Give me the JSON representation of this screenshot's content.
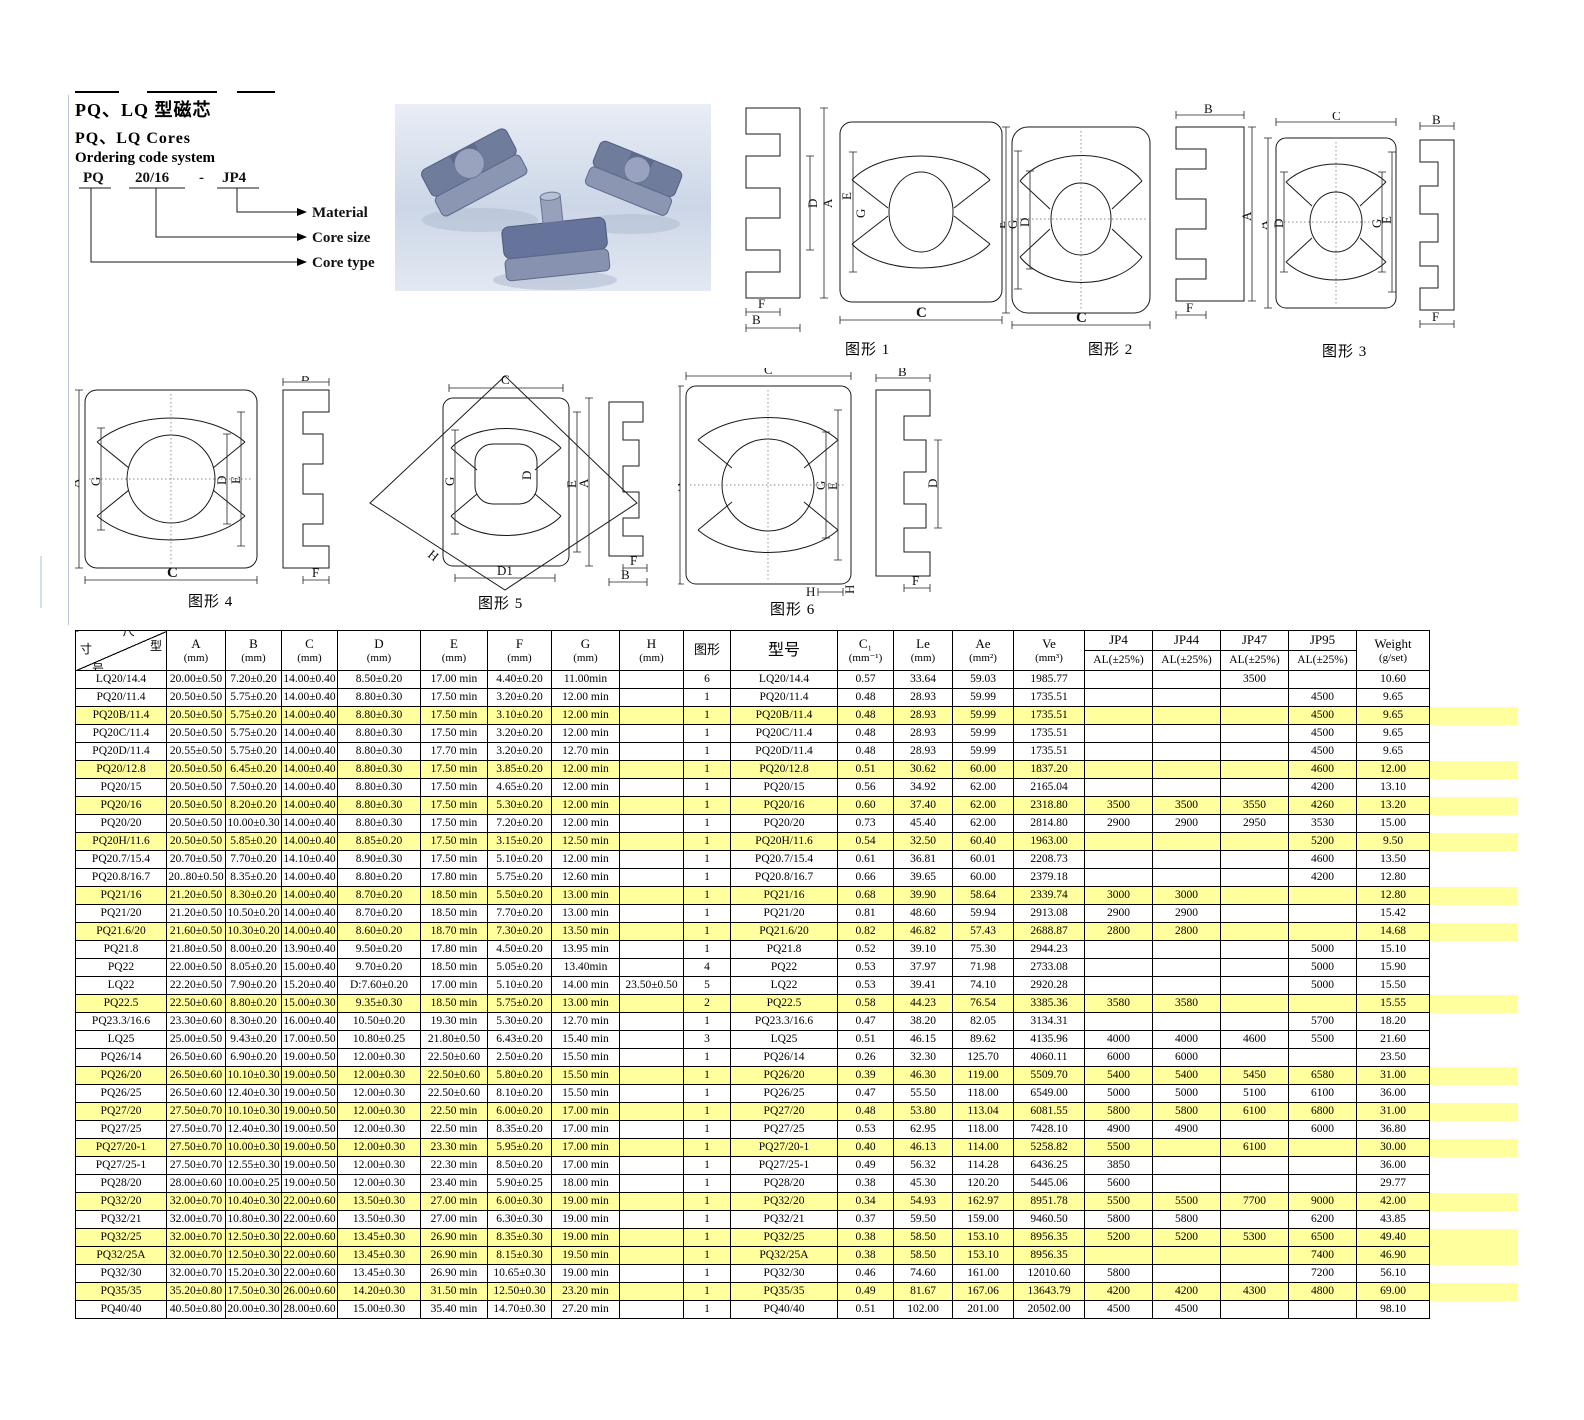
{
  "colors": {
    "highlight": "#ffff9e"
  },
  "page": {
    "title_cn": "PQ、LQ 型磁芯",
    "title_en": "PQ、LQ  Cores",
    "ordering_title": "Ordering code system",
    "code": {
      "part1": "PQ",
      "part2": "20/16",
      "dash": "-",
      "part3": "JP4"
    },
    "code_labels": {
      "material": "Material",
      "core_size": "Core size",
      "core_type": "Core type"
    }
  },
  "figures": {
    "f1": {
      "caption": "图形 1",
      "labels": [
        "D",
        "A",
        "F",
        "B",
        "E",
        "G",
        "C"
      ]
    },
    "f2": {
      "caption": "图形 2",
      "labels": [
        "E",
        "G",
        "D",
        "C",
        "B",
        "A",
        "F"
      ]
    },
    "f3": {
      "caption": "图形 3",
      "labels": [
        "C",
        "A",
        "D",
        "G",
        "E",
        "B",
        "F"
      ]
    },
    "f4": {
      "caption": "图形 4",
      "labels": [
        "A",
        "G",
        "D",
        "E",
        "C",
        "B",
        "F"
      ]
    },
    "f5": {
      "caption": "图形 5",
      "labels": [
        "C",
        "G",
        "D",
        "E",
        "A",
        "H",
        "D1",
        "F",
        "B"
      ]
    },
    "f6": {
      "caption": "图形 6",
      "labels": [
        "C",
        "A",
        "G",
        "E",
        "H",
        "H",
        "B",
        "D",
        "F"
      ]
    }
  },
  "table": {
    "diag": {
      "top": "尺",
      "right": "型",
      "left": "寸",
      "bottom": "号"
    },
    "columns": [
      {
        "l1": "A",
        "l2": "(mm)"
      },
      {
        "l1": "B",
        "l2": "(mm)"
      },
      {
        "l1": "C",
        "l2": "(mm)"
      },
      {
        "l1": "D",
        "l2": "(mm)"
      },
      {
        "l1": "E",
        "l2": "(mm)"
      },
      {
        "l1": "F",
        "l2": "(mm)"
      },
      {
        "l1": "G",
        "l2": "(mm)"
      },
      {
        "l1": "H",
        "l2": "(mm)"
      },
      {
        "l1": "图形"
      },
      {
        "l1": "型号",
        "big": true
      },
      {
        "l1": "C₁",
        "l2": "(mm⁻¹)"
      },
      {
        "l1": "Le",
        "l2": "(mm)"
      },
      {
        "l1": "Ae",
        "l2": "(mm²)"
      },
      {
        "l1": "Ve",
        "l2": "(mm³)"
      },
      {
        "l1": "JP4",
        "l2": "AL(±25%)",
        "split": true
      },
      {
        "l1": "JP44",
        "l2": "AL(±25%)",
        "split": true
      },
      {
        "l1": "JP47",
        "l2": "AL(±25%)",
        "split": true
      },
      {
        "l1": "JP95",
        "l2": "AL(±25%)",
        "split": true
      },
      {
        "l1": "Weight",
        "l2": "(g/set)"
      }
    ],
    "rows": [
      [
        "LQ20/14.4",
        "20.00±0.50",
        "7.20±0.20",
        "14.00±0.40",
        "8.50±0.20",
        "17.00 min",
        "4.40±0.20",
        "11.00min",
        "",
        "6",
        "LQ20/14.4",
        "0.57",
        "33.64",
        "59.03",
        "1985.77",
        "",
        "",
        "3500",
        "",
        "10.60",
        0
      ],
      [
        "PQ20/11.4",
        "20.50±0.50",
        "5.75±0.20",
        "14.00±0.40",
        "8.80±0.30",
        "17.50 min",
        "3.20±0.20",
        "12.00 min",
        "",
        "1",
        "PQ20/11.4",
        "0.48",
        "28.93",
        "59.99",
        "1735.51",
        "",
        "",
        "",
        "4500",
        "9.65",
        0
      ],
      [
        "PQ20B/11.4",
        "20.50±0.50",
        "5.75±0.20",
        "14.00±0.40",
        "8.80±0.30",
        "17.50 min",
        "3.10±0.20",
        "12.00 min",
        "",
        "1",
        "PQ20B/11.4",
        "0.48",
        "28.93",
        "59.99",
        "1735.51",
        "",
        "",
        "",
        "4500",
        "9.65",
        1
      ],
      [
        "PQ20C/11.4",
        "20.50±0.50",
        "5.75±0.20",
        "14.00±0.40",
        "8.80±0.30",
        "17.50 min",
        "3.20±0.20",
        "12.00 min",
        "",
        "1",
        "PQ20C/11.4",
        "0.48",
        "28.93",
        "59.99",
        "1735.51",
        "",
        "",
        "",
        "4500",
        "9.65",
        0
      ],
      [
        "PQ20D/11.4",
        "20.55±0.50",
        "5.75±0.20",
        "14.00±0.40",
        "8.80±0.30",
        "17.70 min",
        "3.20±0.20",
        "12.70 min",
        "",
        "1",
        "PQ20D/11.4",
        "0.48",
        "28.93",
        "59.99",
        "1735.51",
        "",
        "",
        "",
        "4500",
        "9.65",
        0
      ],
      [
        "PQ20/12.8",
        "20.50±0.50",
        "6.45±0.20",
        "14.00±0.40",
        "8.80±0.30",
        "17.50 min",
        "3.85±0.20",
        "12.00 min",
        "",
        "1",
        "PQ20/12.8",
        "0.51",
        "30.62",
        "60.00",
        "1837.20",
        "",
        "",
        "",
        "4600",
        "12.00",
        1
      ],
      [
        "PQ20/15",
        "20.50±0.50",
        "7.50±0.20",
        "14.00±0.40",
        "8.80±0.30",
        "17.50 min",
        "4.65±0.20",
        "12.00 min",
        "",
        "1",
        "PQ20/15",
        "0.56",
        "34.92",
        "62.00",
        "2165.04",
        "",
        "",
        "",
        "4200",
        "13.10",
        0
      ],
      [
        "PQ20/16",
        "20.50±0.50",
        "8.20±0.20",
        "14.00±0.40",
        "8.80±0.30",
        "17.50 min",
        "5.30±0.20",
        "12.00 min",
        "",
        "1",
        "PQ20/16",
        "0.60",
        "37.40",
        "62.00",
        "2318.80",
        "3500",
        "3500",
        "3550",
        "4260",
        "13.20",
        1
      ],
      [
        "PQ20/20",
        "20.50±0.50",
        "10.00±0.30",
        "14.00±0.40",
        "8.80±0.30",
        "17.50 min",
        "7.20±0.20",
        "12.00 min",
        "",
        "1",
        "PQ20/20",
        "0.73",
        "45.40",
        "62.00",
        "2814.80",
        "2900",
        "2900",
        "2950",
        "3530",
        "15.00",
        0
      ],
      [
        "PQ20H/11.6",
        "20.50±0.50",
        "5.85±0.20",
        "14.00±0.40",
        "8.85±0.20",
        "17.50 min",
        "3.15±0.20",
        "12.50 min",
        "",
        "1",
        "PQ20H/11.6",
        "0.54",
        "32.50",
        "60.40",
        "1963.00",
        "",
        "",
        "",
        "5200",
        "9.50",
        1
      ],
      [
        "PQ20.7/15.4",
        "20.70±0.50",
        "7.70±0.20",
        "14.10±0.40",
        "8.90±0.30",
        "17.50 min",
        "5.10±0.20",
        "12.00 min",
        "",
        "1",
        "PQ20.7/15.4",
        "0.61",
        "36.81",
        "60.01",
        "2208.73",
        "",
        "",
        "",
        "4600",
        "13.50",
        0
      ],
      [
        "PQ20.8/16.7",
        "20..80±0.50",
        "8.35±0.20",
        "14.00±0.40",
        "8.80±0.20",
        "17.80 min",
        "5.75±0.20",
        "12.60 min",
        "",
        "1",
        "PQ20.8/16.7",
        "0.66",
        "39.65",
        "60.00",
        "2379.18",
        "",
        "",
        "",
        "4200",
        "12.80",
        0
      ],
      [
        "PQ21/16",
        "21.20±0.50",
        "8.30±0.20",
        "14.00±0.40",
        "8.70±0.20",
        "18.50 min",
        "5.50±0.20",
        "13.00 min",
        "",
        "1",
        "PQ21/16",
        "0.68",
        "39.90",
        "58.64",
        "2339.74",
        "3000",
        "3000",
        "",
        "",
        "12.80",
        1
      ],
      [
        "PQ21/20",
        "21.20±0.50",
        "10.50±0.20",
        "14.00±0.40",
        "8.70±0.20",
        "18.50 min",
        "7.70±0.20",
        "13.00 min",
        "",
        "1",
        "PQ21/20",
        "0.81",
        "48.60",
        "59.94",
        "2913.08",
        "2900",
        "2900",
        "",
        "",
        "15.42",
        0
      ],
      [
        "PQ21.6/20",
        "21.60±0.50",
        "10.30±0.20",
        "14.00±0.40",
        "8.60±0.20",
        "18.70 min",
        "7.30±0.20",
        "13.50 min",
        "",
        "1",
        "PQ21.6/20",
        "0.82",
        "46.82",
        "57.43",
        "2688.87",
        "2800",
        "2800",
        "",
        "",
        "14.68",
        1
      ],
      [
        "PQ21.8",
        "21.80±0.50",
        "8.00±0.20",
        "13.90±0.40",
        "9.50±0.20",
        "17.80 min",
        "4.50±0.20",
        "13.95 min",
        "",
        "1",
        "PQ21.8",
        "0.52",
        "39.10",
        "75.30",
        "2944.23",
        "",
        "",
        "",
        "5000",
        "15.10",
        0
      ],
      [
        "PQ22",
        "22.00±0.50",
        "8.05±0.20",
        "15.00±0.40",
        "9.70±0.20",
        "18.50 min",
        "5.05±0.20",
        "13.40min",
        "",
        "4",
        "PQ22",
        "0.53",
        "37.97",
        "71.98",
        "2733.08",
        "",
        "",
        "",
        "5000",
        "15.90",
        0
      ],
      [
        "LQ22",
        "22.20±0.50",
        "7.90±0.20",
        "15.20±0.40",
        "D:7.60±0.20",
        "17.00 min",
        "5.10±0.20",
        "14.00 min",
        "23.50±0.50",
        "5",
        "LQ22",
        "0.53",
        "39.41",
        "74.10",
        "2920.28",
        "",
        "",
        "",
        "5000",
        "15.50",
        0
      ],
      [
        "PQ22.5",
        "22.50±0.60",
        "8.80±0.20",
        "15.00±0.30",
        "9.35±0.30",
        "18.50 min",
        "5.75±0.20",
        "13.00 min",
        "",
        "2",
        "PQ22.5",
        "0.58",
        "44.23",
        "76.54",
        "3385.36",
        "3580",
        "3580",
        "",
        "",
        "15.55",
        1
      ],
      [
        "PQ23.3/16.6",
        "23.30±0.60",
        "8.30±0.20",
        "16.00±0.40",
        "10.50±0.20",
        "19.30 min",
        "5.30±0.20",
        "12.70 min",
        "",
        "1",
        "PQ23.3/16.6",
        "0.47",
        "38.20",
        "82.05",
        "3134.31",
        "",
        "",
        "",
        "5700",
        "18.20",
        0
      ],
      [
        "LQ25",
        "25.00±0.50",
        "9.43±0.20",
        "17.00±0.50",
        "10.80±0.25",
        "21.80±0.50",
        "6.43±0.20",
        "15.40 min",
        "",
        "3",
        "LQ25",
        "0.51",
        "46.15",
        "89.62",
        "4135.96",
        "4000",
        "4000",
        "4600",
        "5500",
        "21.60",
        0
      ],
      [
        "PQ26/14",
        "26.50±0.60",
        "6.90±0.20",
        "19.00±0.50",
        "12.00±0.30",
        "22.50±0.60",
        "2.50±0.20",
        "15.50 min",
        "",
        "1",
        "PQ26/14",
        "0.26",
        "32.30",
        "125.70",
        "4060.11",
        "6000",
        "6000",
        "",
        "",
        "23.50",
        0
      ],
      [
        "PQ26/20",
        "26.50±0.60",
        "10.10±0.30",
        "19.00±0.50",
        "12.00±0.30",
        "22.50±0.60",
        "5.80±0.20",
        "15.50 min",
        "",
        "1",
        "PQ26/20",
        "0.39",
        "46.30",
        "119.00",
        "5509.70",
        "5400",
        "5400",
        "5450",
        "6580",
        "31.00",
        1
      ],
      [
        "PQ26/25",
        "26.50±0.60",
        "12.40±0.30",
        "19.00±0.50",
        "12.00±0.30",
        "22.50±0.60",
        "8.10±0.20",
        "15.50 min",
        "",
        "1",
        "PQ26/25",
        "0.47",
        "55.50",
        "118.00",
        "6549.00",
        "5000",
        "5000",
        "5100",
        "6100",
        "36.00",
        0
      ],
      [
        "PQ27/20",
        "27.50±0.70",
        "10.10±0.30",
        "19.00±0.50",
        "12.00±0.30",
        "22.50 min",
        "6.00±0.20",
        "17.00 min",
        "",
        "1",
        "PQ27/20",
        "0.48",
        "53.80",
        "113.04",
        "6081.55",
        "5800",
        "5800",
        "6100",
        "6800",
        "31.00",
        1
      ],
      [
        "PQ27/25",
        "27.50±0.70",
        "12.40±0.30",
        "19.00±0.50",
        "12.00±0.30",
        "22.50 min",
        "8.35±0.20",
        "17.00 min",
        "",
        "1",
        "PQ27/25",
        "0.53",
        "62.95",
        "118.00",
        "7428.10",
        "4900",
        "4900",
        "",
        "6000",
        "36.80",
        0
      ],
      [
        "PQ27/20-1",
        "27.50±0.70",
        "10.00±0.30",
        "19.00±0.50",
        "12.00±0.30",
        "23.30 min",
        "5.95±0.20",
        "17.00 min",
        "",
        "1",
        "PQ27/20-1",
        "0.40",
        "46.13",
        "114.00",
        "5258.82",
        "5500",
        "",
        "6100",
        "",
        "30.00",
        1
      ],
      [
        "PQ27/25-1",
        "27.50±0.70",
        "12.55±0.30",
        "19.00±0.50",
        "12.00±0.30",
        "22.30 min",
        "8.50±0.20",
        "17.00 min",
        "",
        "1",
        "PQ27/25-1",
        "0.49",
        "56.32",
        "114.28",
        "6436.25",
        "3850",
        "",
        "",
        "",
        "36.00",
        0
      ],
      [
        "PQ28/20",
        "28.00±0.60",
        "10.00±0.25",
        "19.00±0.50",
        "12.00±0.30",
        "23.40 min",
        "5.90±0.25",
        "18.00 min",
        "",
        "1",
        "PQ28/20",
        "0.38",
        "45.30",
        "120.20",
        "5445.06",
        "5600",
        "",
        "",
        "",
        "29.77",
        0
      ],
      [
        "PQ32/20",
        "32.00±0.70",
        "10.40±0.30",
        "22.00±0.60",
        "13.50±0.30",
        "27.00 min",
        "6.00±0.30",
        "19.00 min",
        "",
        "1",
        "PQ32/20",
        "0.34",
        "54.93",
        "162.97",
        "8951.78",
        "5500",
        "5500",
        "7700",
        "9000",
        "42.00",
        1
      ],
      [
        "PQ32/21",
        "32.00±0.70",
        "10.80±0.30",
        "22.00±0.60",
        "13.50±0.30",
        "27.00 min",
        "6.30±0.30",
        "19.00 min",
        "",
        "1",
        "PQ32/21",
        "0.37",
        "59.50",
        "159.00",
        "9460.50",
        "5800",
        "5800",
        "",
        "6200",
        "43.85",
        0
      ],
      [
        "PQ32/25",
        "32.00±0.70",
        "12.50±0.30",
        "22.00±0.60",
        "13.45±0.30",
        "26.90 min",
        "8.35±0.30",
        "19.00 min",
        "",
        "1",
        "PQ32/25",
        "0.38",
        "58.50",
        "153.10",
        "8956.35",
        "5200",
        "5200",
        "5300",
        "6500",
        "49.40",
        1
      ],
      [
        "PQ32/25A",
        "32.00±0.70",
        "12.50±0.30",
        "22.00±0.60",
        "13.45±0.30",
        "26.90 min",
        "8.15±0.30",
        "19.50 min",
        "",
        "1",
        "PQ32/25A",
        "0.38",
        "58.50",
        "153.10",
        "8956.35",
        "",
        "",
        "",
        "7400",
        "46.90",
        1
      ],
      [
        "PQ32/30",
        "32.00±0.70",
        "15.20±0.30",
        "22.00±0.60",
        "13.45±0.30",
        "26.90 min",
        "10.65±0.30",
        "19.00 min",
        "",
        "1",
        "PQ32/30",
        "0.46",
        "74.60",
        "161.00",
        "12010.60",
        "5800",
        "",
        "",
        "7200",
        "56.10",
        0
      ],
      [
        "PQ35/35",
        "35.20±0.80",
        "17.50±0.30",
        "26.00±0.60",
        "14.20±0.30",
        "31.50 min",
        "12.50±0.30",
        "23.20 min",
        "",
        "1",
        "PQ35/35",
        "0.49",
        "81.67",
        "167.06",
        "13643.79",
        "4200",
        "4200",
        "4300",
        "4800",
        "69.00",
        1
      ],
      [
        "PQ40/40",
        "40.50±0.80",
        "20.00±0.30",
        "28.00±0.60",
        "15.00±0.30",
        "35.40 min",
        "14.70±0.30",
        "27.20 min",
        "",
        "1",
        "PQ40/40",
        "0.51",
        "102.00",
        "201.00",
        "20502.00",
        "4500",
        "4500",
        "",
        "",
        "98.10",
        0
      ]
    ]
  }
}
